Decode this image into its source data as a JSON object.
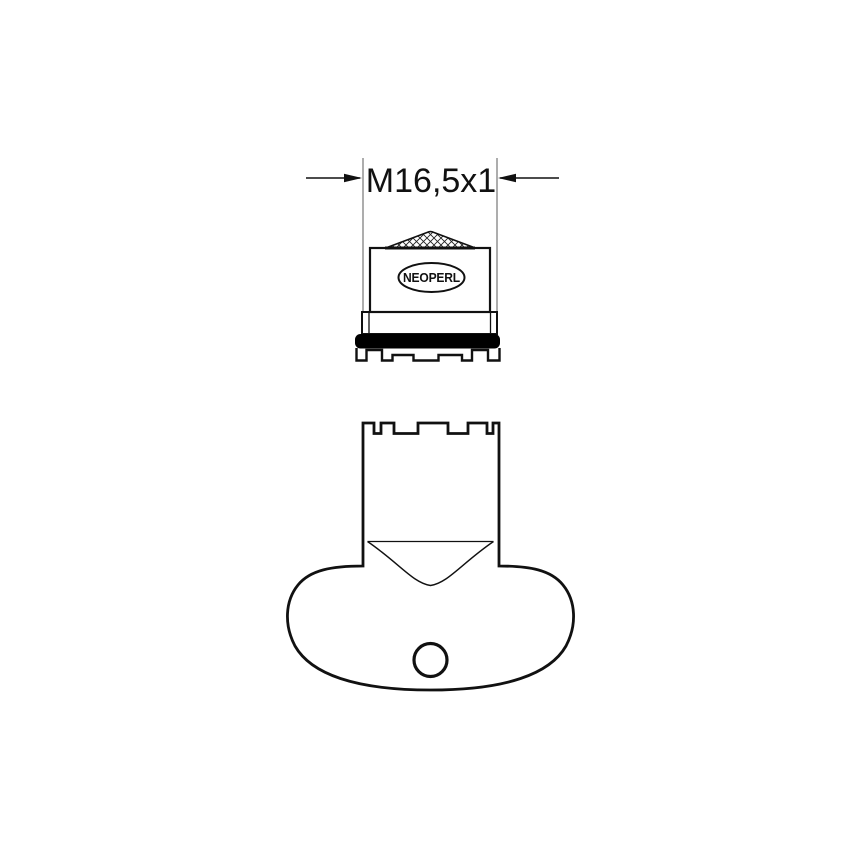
{
  "drawing": {
    "dimension": {
      "label": "M16,5x1"
    },
    "aerator": {
      "brand": "NEOPERL",
      "part": "faucet-aerator-side-view"
    },
    "key": {
      "part": "aerator-service-key-side-view"
    },
    "colors": {
      "line": "#111111",
      "extension": "#8a8a8a",
      "gasket": "#000000",
      "background": "#ffffff"
    }
  }
}
